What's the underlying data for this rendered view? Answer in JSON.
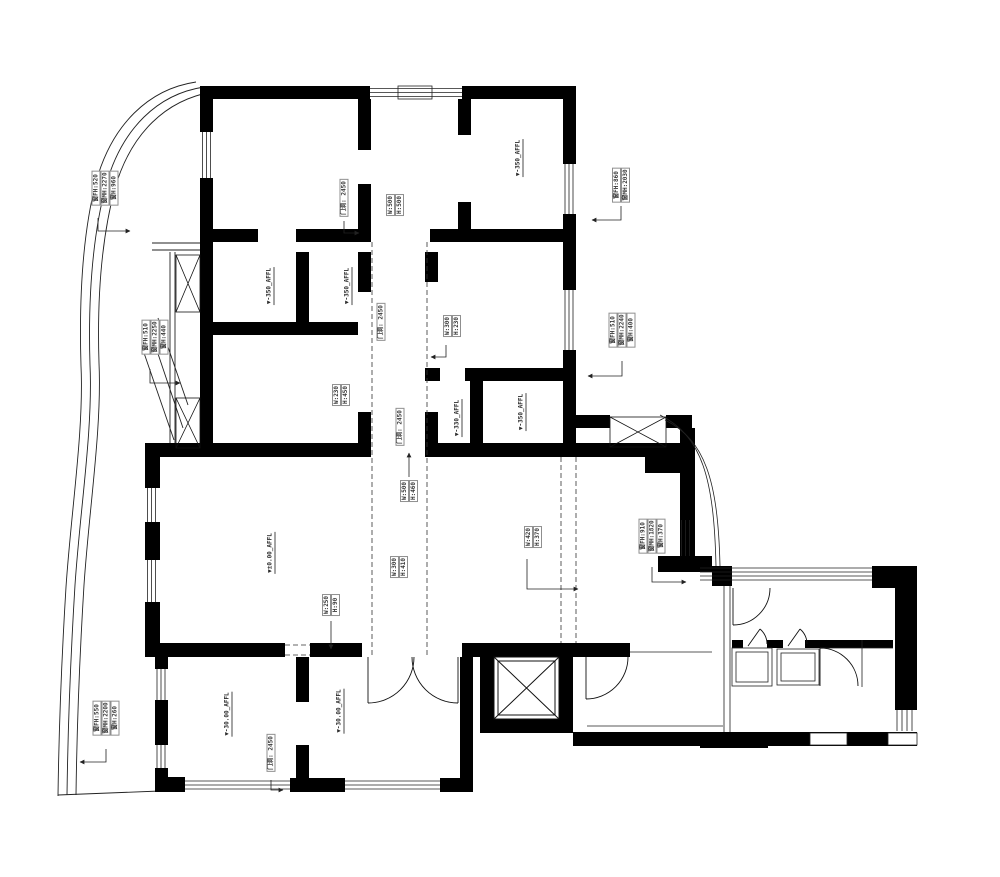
{
  "colors": {
    "wall": "#000000",
    "thin_line": "#222222",
    "label_border": "#8f8f8f",
    "label_text": "#3a3a3a"
  },
  "labels": {
    "window_tl": {
      "lines": [
        "窗FH:520",
        "窗MH:2270",
        "窗H:960"
      ]
    },
    "window_tr": {
      "lines": [
        "窗FH:860",
        "窗MH:2030"
      ]
    },
    "window_left_mid": {
      "lines": [
        "窗FH:510",
        "窗MH:2250",
        "窗H:440"
      ]
    },
    "window_right_mid": {
      "lines": [
        "窗FH:510",
        "窗MH:2240",
        "窗H:400"
      ]
    },
    "window_right_low": {
      "lines": [
        "窗FH:910",
        "窗MH:1820",
        "窗H:370"
      ]
    },
    "window_bottom_left": {
      "lines": [
        "窗FH:550",
        "窗MH:2200",
        "窗H:260"
      ]
    },
    "door_opening_top": "门洞: 2450",
    "door_opening_hall_upper": "门洞: 2450",
    "door_opening_hall_lower": "门洞: 2450",
    "door_opening_bottom": "门洞: 2450",
    "niche_top": {
      "lines": [
        "W:500",
        "H:500"
      ]
    },
    "niche_right_upper": {
      "lines": [
        "W:300",
        "H:230"
      ]
    },
    "niche_hall_left": {
      "lines": [
        "W:230",
        "H:450"
      ]
    },
    "niche_hall_center": {
      "lines": [
        "W:500",
        "H:460"
      ]
    },
    "niche_hall_lower": {
      "lines": [
        "W:300",
        "H:410"
      ]
    },
    "niche_living": {
      "lines": [
        "W:250",
        "H:90"
      ]
    },
    "niche_dining": {
      "lines": [
        "W:420",
        "H:370"
      ]
    },
    "level_top_right": "▼-350_AFFL",
    "level_mid_left_1": "▼-350_AFFL",
    "level_mid_left_2": "▼-350_AFFL",
    "level_mid_right_1": "▼-330_AFFL",
    "level_mid_right_2": "▼-350_AFFL",
    "level_living": "▼±0.00_AFFL",
    "level_bottom_left_1": "▼-30.00_AFFL",
    "level_bottom_left_2": "▼-30.00_AFFL"
  }
}
